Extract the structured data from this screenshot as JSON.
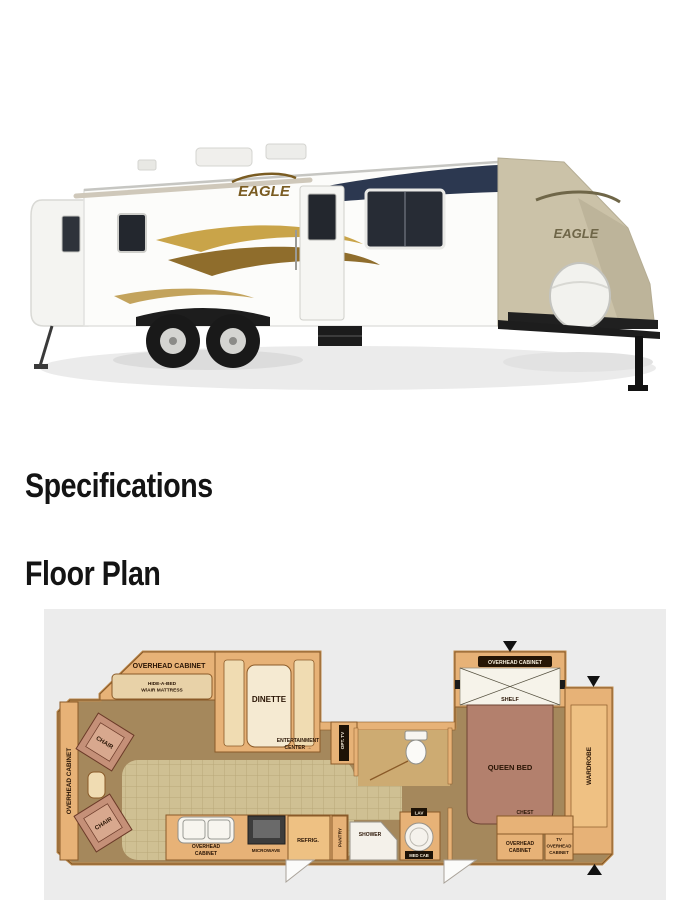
{
  "headings": {
    "specifications": "Specifications",
    "floor_plan": "Floor Plan"
  },
  "hero": {
    "logo_side": "EAGLE",
    "logo_front": "EAGLE"
  },
  "colors": {
    "floorplan_background": "#ececec",
    "cabinet_tan": "#e7b277",
    "carpet_brown": "#a5885c",
    "tile_tan": "#cfc093",
    "bed_mauve": "#b3806d",
    "accent_gold": "#c9a449",
    "accent_navy": "#2c3850"
  },
  "floorplan": {
    "labels": {
      "overhead_cabinet": "OVERHEAD CABINET",
      "overhead_line1": "OVERHEAD",
      "overhead_line2": "CABINET",
      "hide_a_bed_line1": "HIDE-A-BED",
      "hide_a_bed_line2": "W/AIR MATTRESS",
      "dinette": "DINETTE",
      "entertainment_line1": "ENTERTAINMENT",
      "entertainment_line2": "CENTER →",
      "opt_tv": "OPT. TV",
      "chair": "CHAIR",
      "shelf": "SHELF",
      "queen_bed": "QUEEN BED",
      "wardrobe": "WARDROBE",
      "chest": "CHEST",
      "tv": "TV",
      "microwave": "MICROWAVE",
      "refrig": "REFRIG.",
      "pantry": "PANTRY",
      "shower": "SHOWER",
      "lav": "LAV",
      "med_cab": "MED CAB"
    }
  }
}
